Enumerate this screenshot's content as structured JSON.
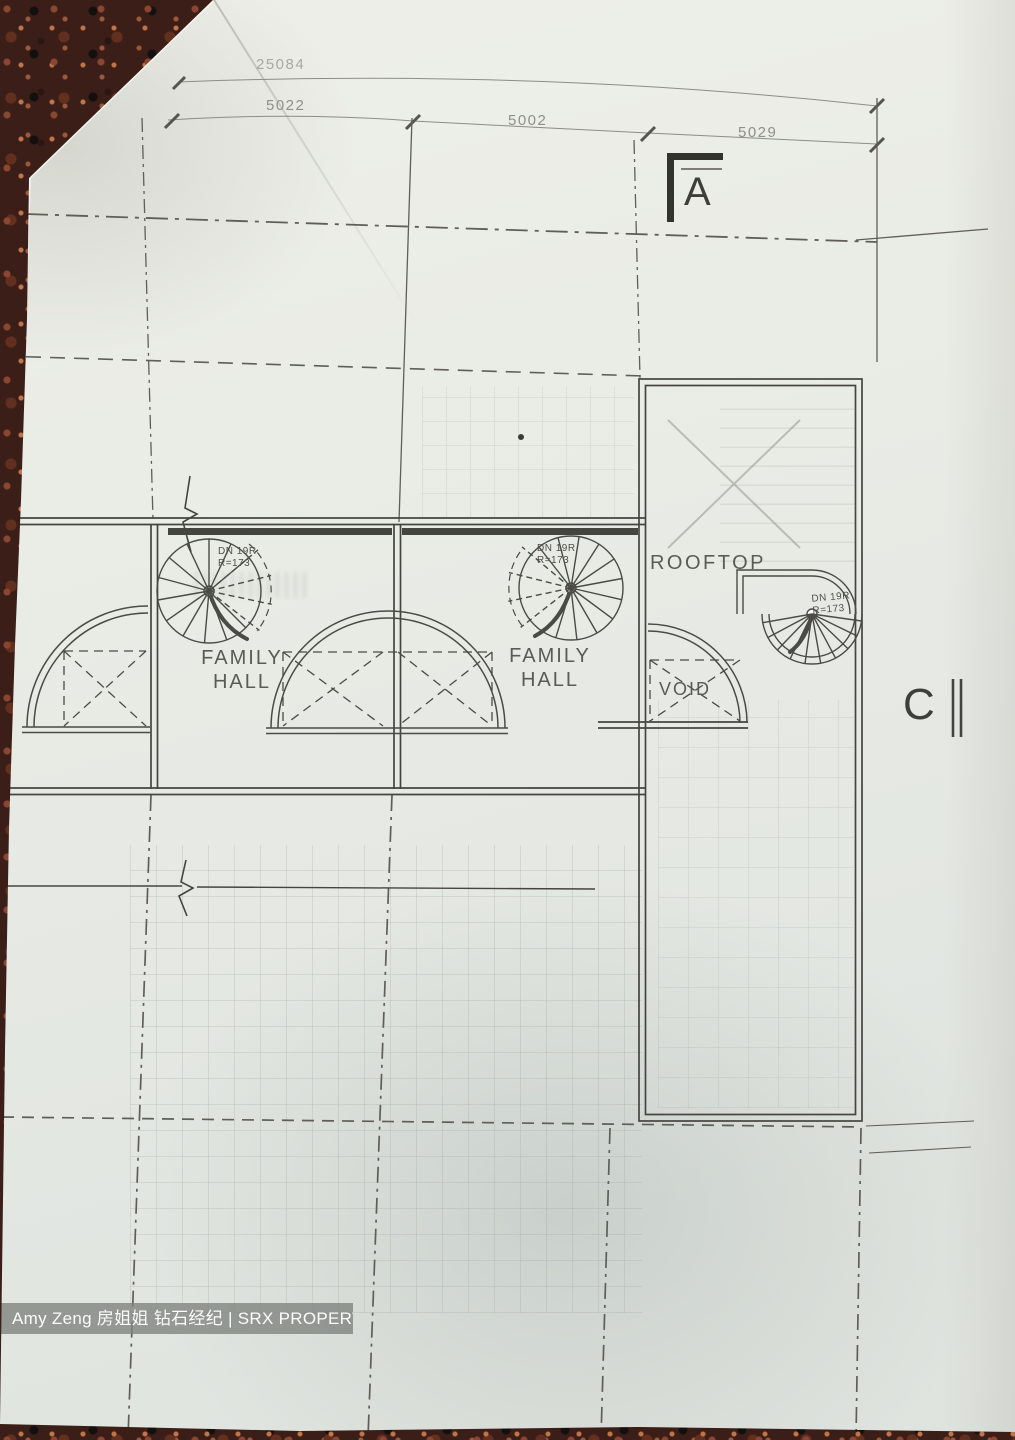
{
  "plan": {
    "dimensions": {
      "overall": "25084",
      "bay1": "5022",
      "bay2": "5002",
      "bay3": "5029"
    },
    "section_markers": {
      "a": "A",
      "c": "C"
    },
    "rooms": {
      "family_hall_1": "FAMILY\nHALL",
      "family_hall_2": "FAMILY\nHALL",
      "rooftop": "ROOFTOP",
      "void": "VOID",
      "left_label_fragment": "Y"
    },
    "stairs": {
      "label": "DN 19R\nR=173"
    }
  },
  "watermark": {
    "text": "Amy Zeng 房姐姐 钻石经纪 | SRX PROPERTY"
  },
  "colors": {
    "paper": "#e8eae4",
    "granite": "#3c1e18",
    "ink": "#4b4b45",
    "watermark_bar": "#82867f"
  }
}
